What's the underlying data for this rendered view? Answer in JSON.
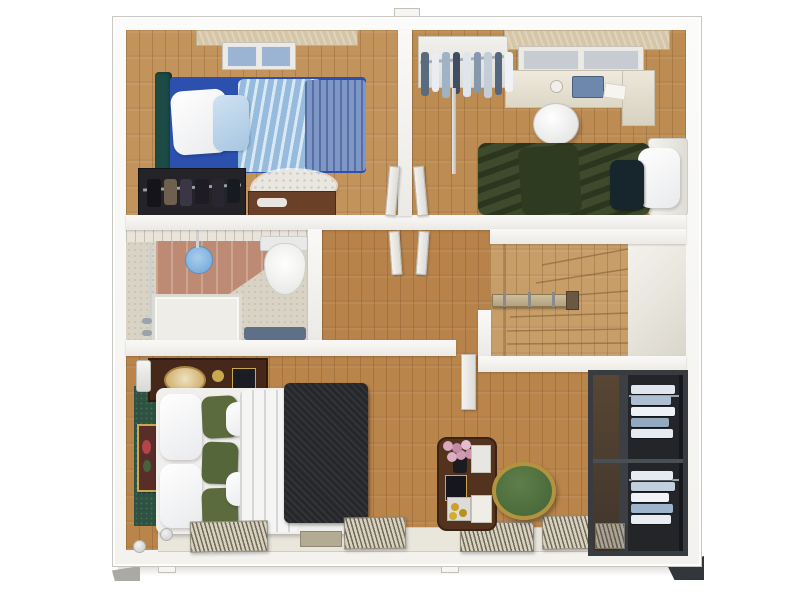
{
  "scene": {
    "title": "3D top-down floor plan render",
    "view": "dollhouse cutaway, upper floor",
    "background": "white studio"
  },
  "palette": {
    "wall_edge": "#c9c7c2",
    "wood_hall": "#b8834a",
    "wood_bed1": "#c3935c",
    "wood_bed2": "#bd8c52",
    "wood_master": "#b9854b",
    "wood_stairs": "#c79d68",
    "tile_bath": "#d9d3c5",
    "terracotta": "#bd8a73",
    "bed1_frame": "#2b50ae",
    "bed1_duvet_light": "#a8cbe8",
    "bed1_duvet_denim": "#7e97c6",
    "bed1_headboard": "#1c4a45",
    "bed2_duvet": "#3d4a2b",
    "master_blanket": "#25272b",
    "olive_pillow": "#5c6b3e",
    "green_headboard": "#2d5242",
    "stool_green": "#4c6b3c",
    "stool_gold": "#b2933f",
    "closet_dark": "#2c2f34",
    "bath_mat_blue": "#5d7087",
    "shower_blue": "#7fb2e0",
    "curtain_beige": "#d6c6a8",
    "console_brown": "#53331e"
  },
  "rooms": {
    "bedroom1": {
      "label": "Bedroom with blue single bed",
      "furniture": [
        "single bed with light-blue and denim-blue duvets",
        "white and blue pillows",
        "dark teal headboard",
        "open wardrobe with dark clothes and shoes",
        "wooden nightstand",
        "white shag rug",
        "window with beige curtain"
      ]
    },
    "bedroom2": {
      "label": "Bedroom with green double bed",
      "furniture": [
        "double bed with dark green duvet",
        "white pillow",
        "dark pillow",
        "desk with laptop and lamp",
        "white desk chair",
        "open clothes rack with hanging shirts",
        "window with beige curtain"
      ]
    },
    "bathroom": {
      "label": "Bathroom",
      "furniture": [
        "walk-in shower with blue rain head",
        "terracotta tiled shower wall",
        "white toilet",
        "shower tray",
        "blue bath mat"
      ]
    },
    "hallway": {
      "label": "Hallway / landing",
      "furniture": [
        "open white doors to both bedrooms",
        "wood plank flooring"
      ]
    },
    "staircase": {
      "label": "Winder staircase",
      "furniture": [
        "wooden winder treads",
        "timber handrail with posts"
      ]
    },
    "master_bedroom": {
      "label": "Master bedroom",
      "furniture": [
        "double bed with white duvet and charcoal throw",
        "olive green pillows",
        "green fabric headboard wall with framed art",
        "dark wood dresser with lamp and tray",
        "console table with pink flowers and books",
        "round green stool with gold rim",
        "window radiators"
      ]
    },
    "closet": {
      "label": "Built-in wardrobe",
      "furniture": [
        "dark framed closet",
        "rails with folded white and blue clothes",
        "radiator"
      ]
    }
  }
}
